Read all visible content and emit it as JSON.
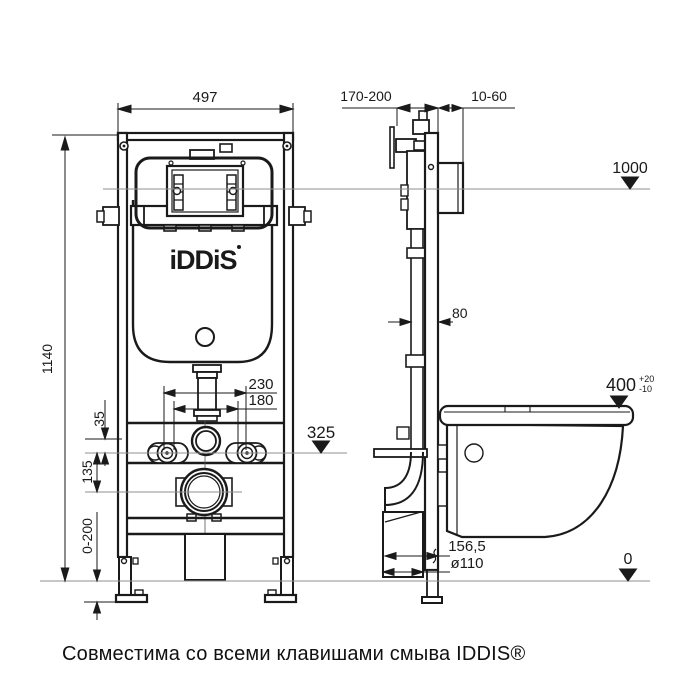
{
  "caption": "Совместима со всеми клавишами смыва IDDIS®",
  "logo": {
    "text": "iDDiS"
  },
  "colors": {
    "line": "#1a1a1a",
    "reference": "#8f8f8f",
    "background": "#ffffff"
  },
  "front_view": {
    "width": "497",
    "height": "1140",
    "bolt_spacing_outer": "230",
    "bolt_spacing_inner": "180",
    "flush_to_bolts": "35",
    "bolts_to_drain": "135",
    "bolts_level": "325",
    "feet_range": "0-200"
  },
  "side_view": {
    "inlet_depth": "170-200",
    "wall_range": "10-60",
    "top_level": "1000",
    "pipe_depth": "80",
    "seat_height": "400",
    "seat_tol_plus": "+20",
    "seat_tol_minus": "-10",
    "drain_distance": "156,5",
    "drain_diameter": "ø110",
    "floor_level": "0"
  }
}
